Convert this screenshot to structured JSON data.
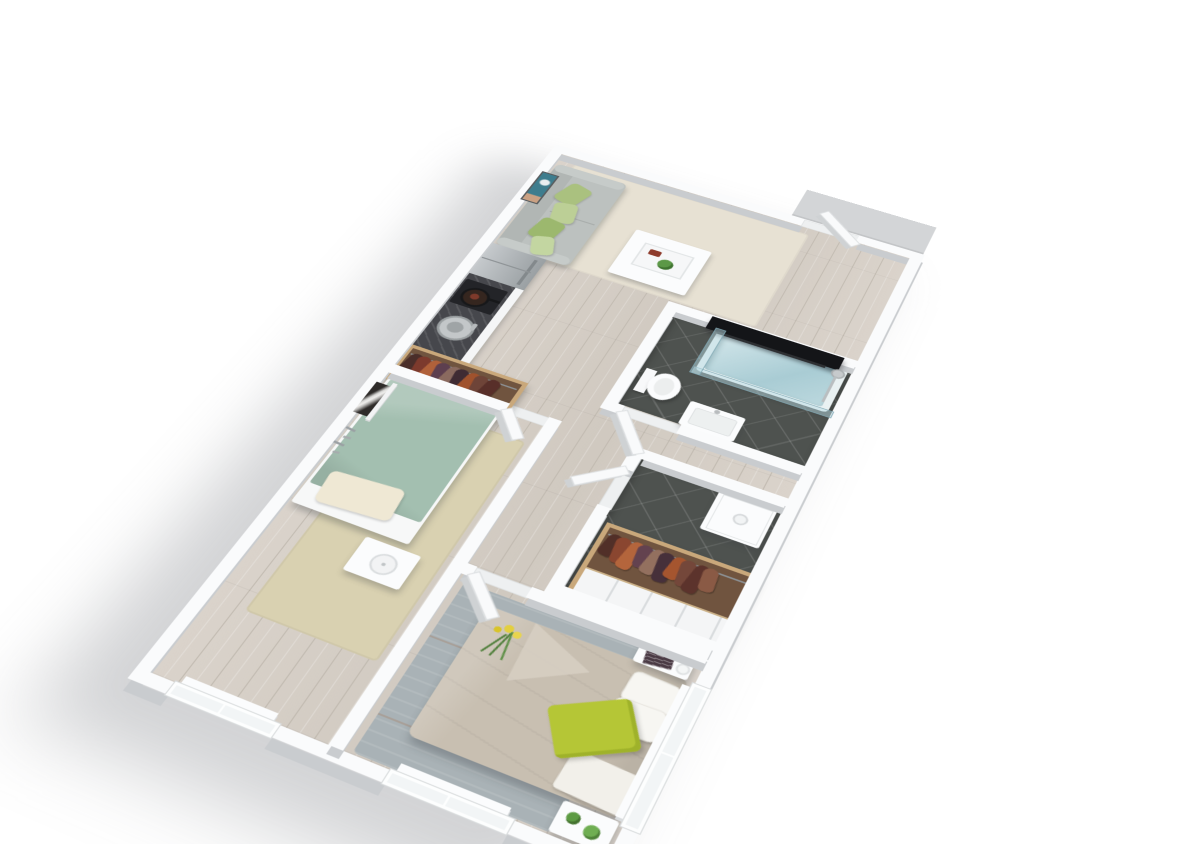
{
  "meta": {
    "title": "3D isometric floor plan of a one-bedroom apartment",
    "background": "#ffffff"
  },
  "palette": {
    "wall": "#fafbfc",
    "wallFace": "#c9cccf",
    "woodA": "#dad3cb",
    "woodB": "#d0c9c0",
    "woodSeam": "#c0b9af",
    "tile": "#4e524f",
    "rugLiving": "#e7e1d3",
    "rugBed1": "#d9d1b1",
    "rugBed2": "#a9b2b6",
    "sofa": "#bcc1bf",
    "sofaBack": "#b1b6b4",
    "duvetSage": "#a3bfb0",
    "duvetTaupe": "#c8bfb1",
    "pillowCream": "#efe8d4",
    "pillowWhite": "#f7f6f2",
    "pillowChartreuse": "#b5c636",
    "counterTop": "#46474c",
    "stove": "#232428",
    "steel": "#b6babc",
    "tubRim": "#e9f1f2",
    "tv": "#141518",
    "woodFrame": "#c9a87b",
    "rackBg": "#70543f",
    "door": "#f9fafb",
    "landing": "#d3d5d7",
    "artTeal": "#3e7d8e",
    "plantGreen": "#5c9847"
  },
  "rooms": {
    "living": {
      "name": "Living room"
    },
    "kitchen": {
      "name": "Open kitchen"
    },
    "bathroom": {
      "name": "Bathroom with glass shower tub"
    },
    "hallway": {
      "name": "Hallway"
    },
    "storage": {
      "name": "Storage and laundry room"
    },
    "bedroom1": {
      "name": "Small bedroom"
    },
    "bedroom2": {
      "name": "Master bedroom"
    }
  },
  "furniture": {
    "sofa": {
      "name": "Grey sofa with green cushions",
      "cushions": 4
    },
    "coffee_table": {
      "name": "White coffee table with tray and plant"
    },
    "tv": {
      "name": "Wall-mounted television"
    },
    "art_living": {
      "name": "Teal wall artwork"
    },
    "fridge": {
      "name": "Stainless steel refrigerator"
    },
    "counter": {
      "name": "Kitchen counter with stove and sink"
    },
    "tub": {
      "name": "Bathtub with glass screen"
    },
    "toilet": {
      "name": "Toilet"
    },
    "sink": {
      "name": "Bathroom sink"
    },
    "washer": {
      "name": "Washing machine"
    },
    "bed1": {
      "name": "Single bed with sage duvet"
    },
    "lamp_table": {
      "name": "Nightstand with lamp"
    },
    "art_bed1": {
      "name": "Black and white artwork on ledge"
    },
    "bed2": {
      "name": "Double bed with taupe duvet and green pillow"
    },
    "book_table": {
      "name": "Nightstand with magazine and glass"
    },
    "plant_table": {
      "name": "Side table with potted plants"
    },
    "entry_door": {
      "name": "Entry door"
    }
  },
  "wardrobes": {
    "hall": {
      "name": "Open wardrobe with hanging clothes",
      "clothes": [
        "#4a2e2a",
        "#7c3a2d",
        "#b0613a",
        "#5d3f4f",
        "#8a6a5f",
        "#3f2b33",
        "#a0522d",
        "#6e4438",
        "#582f29"
      ]
    },
    "storage": {
      "name": "Open wardrobe with hanging clothes and drawers",
      "clothes": [
        "#512f28",
        "#8a4630",
        "#b4653c",
        "#63424f",
        "#93705f",
        "#46303a",
        "#a5552f",
        "#74473a",
        "#5c332c",
        "#8a5a45"
      ]
    }
  },
  "windows": {
    "bedroom1_count": 1,
    "bedroom2_count": 2,
    "side_count": 1
  },
  "doors": {
    "count": 5
  }
}
